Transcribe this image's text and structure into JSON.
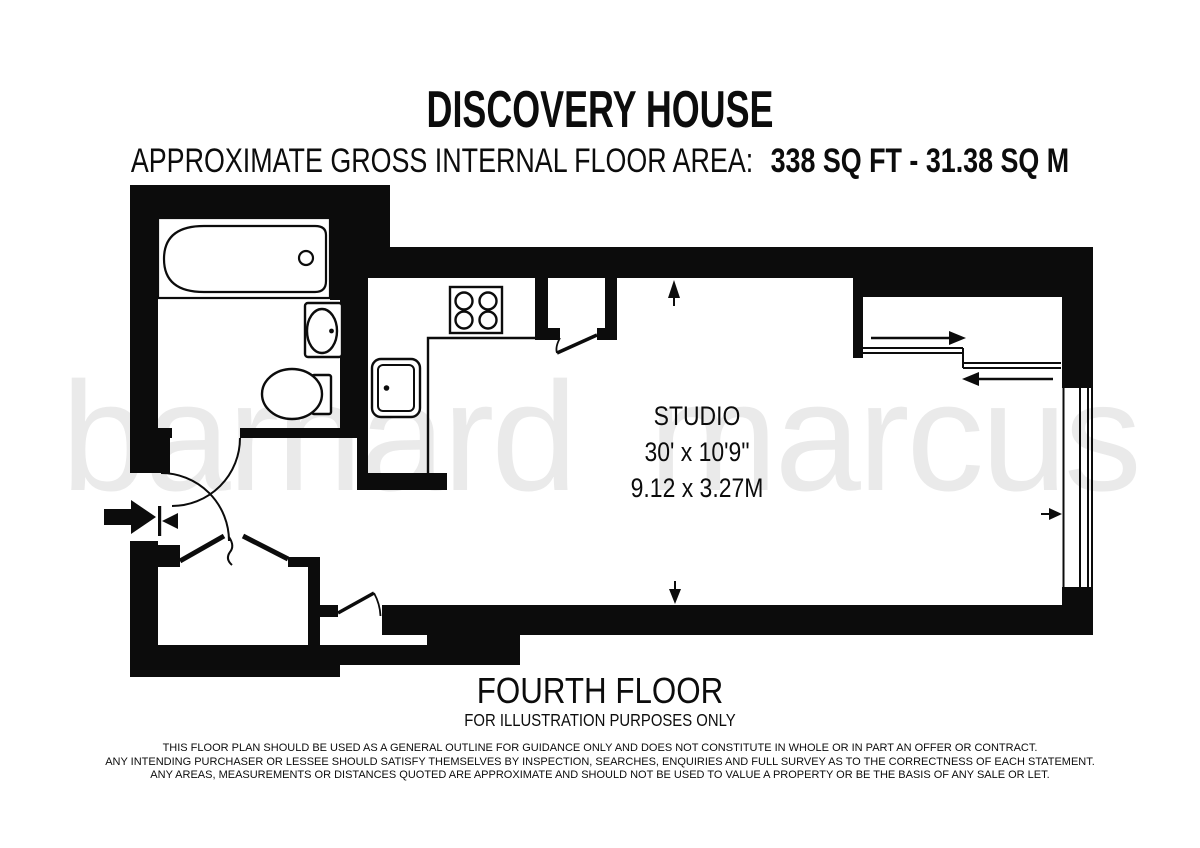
{
  "header": {
    "building_name": "DISCOVERY HOUSE",
    "area_label": "APPROXIMATE GROSS INTERNAL FLOOR AREA:",
    "area_value": "338 SQ FT - 31.38 SQ M"
  },
  "watermark": {
    "text": "barnard marcus",
    "color": "#eaeaea"
  },
  "plan": {
    "room_label": {
      "name": "STUDIO",
      "size_imperial": "30' x 10'9\"",
      "size_metric": "9.12 x 3.27M"
    },
    "fixtures": [
      "bathtub",
      "wash-basin",
      "toilet",
      "hob",
      "kitchen-sink",
      "worktop",
      "cupboard",
      "sliding-storage-recess",
      "window",
      "entrance-door",
      "closet-bifold-doors"
    ],
    "colors": {
      "walls": "#0c0c0c",
      "background": "#ffffff"
    }
  },
  "footer": {
    "floor_label": "FOURTH FLOOR",
    "note": "FOR ILLUSTRATION PURPOSES ONLY",
    "disclaimer_lines": [
      "THIS FLOOR PLAN SHOULD BE USED AS A GENERAL OUTLINE FOR GUIDANCE ONLY AND DOES NOT CONSTITUTE IN WHOLE OR IN PART AN OFFER OR CONTRACT.",
      "ANY INTENDING PURCHASER OR LESSEE SHOULD SATISFY THEMSELVES BY INSPECTION, SEARCHES, ENQUIRIES AND FULL SURVEY AS TO THE CORRECTNESS OF EACH STATEMENT.",
      "ANY AREAS, MEASUREMENTS OR DISTANCES QUOTED ARE APPROXIMATE AND SHOULD NOT BE USED TO VALUE A PROPERTY OR BE THE BASIS OF ANY SALE OR LET."
    ]
  }
}
